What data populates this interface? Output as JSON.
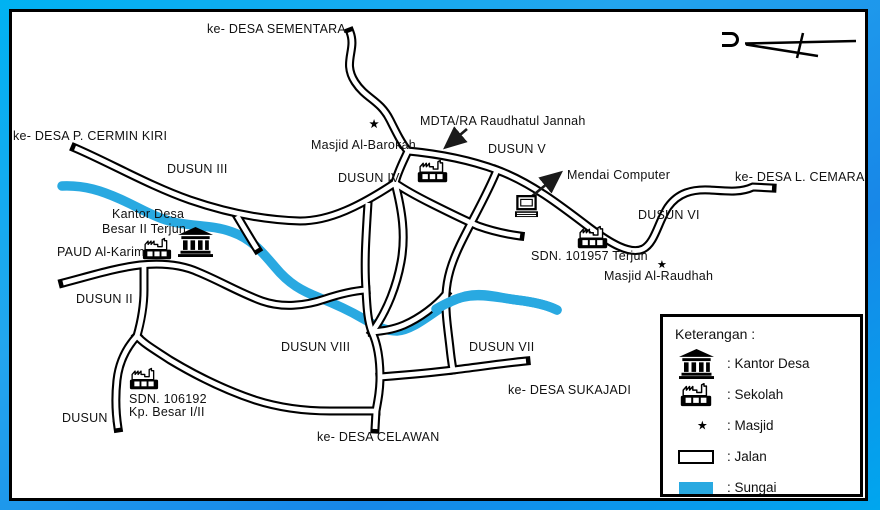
{
  "compass": {
    "north_symbol": "U"
  },
  "colors": {
    "river": "#29a9e1",
    "road_fill": "#ffffff",
    "road_outline": "#000000",
    "frame_blue_light": "#00b2f2",
    "frame_blue_dark": "#1787e8",
    "map_background": "#ffffff",
    "text": "#111111"
  },
  "map": {
    "labels": [
      {
        "id": "ke-desa-sementara",
        "text": "ke- DESA SEMENTARA",
        "x": 207,
        "y": 23
      },
      {
        "id": "ke-desa-p-cermin-kiri",
        "text": "ke- DESA P. CERMIN KIRI",
        "x": 13,
        "y": 130
      },
      {
        "id": "dusun-iii",
        "text": "DUSUN III",
        "x": 167,
        "y": 163
      },
      {
        "id": "masjid-al-barokah",
        "text": "Masjid Al-Barokah",
        "x": 311,
        "y": 139
      },
      {
        "id": "mdta-ra-raudhatul-jannah",
        "text": "MDTA/RA Raudhatul Jannah",
        "x": 420,
        "y": 115
      },
      {
        "id": "dusun-v",
        "text": "DUSUN V",
        "x": 488,
        "y": 143
      },
      {
        "id": "dusun-iv",
        "text": "DUSUN IV",
        "x": 338,
        "y": 172
      },
      {
        "id": "mendai-computer",
        "text": "Mendai Computer",
        "x": 567,
        "y": 169
      },
      {
        "id": "ke-desa-l-cemara",
        "text": "ke- DESA L. CEMARA",
        "x": 735,
        "y": 171
      },
      {
        "id": "dusun-vi",
        "text": "DUSUN VI",
        "x": 638,
        "y": 209
      },
      {
        "id": "sdn-101957-terjun",
        "text": "SDN. 101957 Terjun",
        "x": 531,
        "y": 250
      },
      {
        "id": "masjid-al-raudhah",
        "text": "Masjid Al-Raudhah",
        "x": 604,
        "y": 270
      },
      {
        "id": "kantor-desa-line1",
        "text": "Kantor Desa",
        "x": 112,
        "y": 208
      },
      {
        "id": "kantor-desa-line2",
        "text": "Besar II Terjun",
        "x": 102,
        "y": 223
      },
      {
        "id": "paud-al-karim",
        "text": "PAUD Al-Karim",
        "x": 57,
        "y": 246
      },
      {
        "id": "dusun-ii",
        "text": "DUSUN II",
        "x": 76,
        "y": 293
      },
      {
        "id": "sdn-106192-line1",
        "text": "SDN. 106192",
        "x": 129,
        "y": 393
      },
      {
        "id": "sdn-106192-line2",
        "text": "Kp. Besar I/II",
        "x": 129,
        "y": 406
      },
      {
        "id": "dusun-i",
        "text": "DUSUN I",
        "x": 62,
        "y": 412
      },
      {
        "id": "dusun-viii",
        "text": "DUSUN VIII",
        "x": 281,
        "y": 341
      },
      {
        "id": "dusun-vii",
        "text": "DUSUN VII",
        "x": 469,
        "y": 341
      },
      {
        "id": "ke-desa-sukajadi",
        "text": "ke- DESA SUKAJADI",
        "x": 508,
        "y": 384
      },
      {
        "id": "ke-desa-celawan",
        "text": "ke- DESA CELAWAN",
        "x": 317,
        "y": 431
      }
    ],
    "places": [
      {
        "id": "masjid-al-barokah-icon",
        "icon": "masjid",
        "x": 354,
        "y": 110,
        "w": 28,
        "h": 28
      },
      {
        "id": "mdta-school-icon",
        "icon": "sekolah",
        "x": 417,
        "y": 159,
        "w": 31,
        "h": 24
      },
      {
        "id": "mendai-computer-icon",
        "icon": "komputer",
        "x": 512,
        "y": 195,
        "w": 29,
        "h": 23
      },
      {
        "id": "sdn-101957-school-icon",
        "icon": "sekolah",
        "x": 577,
        "y": 225,
        "w": 31,
        "h": 24
      },
      {
        "id": "masjid-al-raudhah-icon",
        "icon": "masjid",
        "x": 644,
        "y": 252,
        "w": 25,
        "h": 25
      },
      {
        "id": "kantor-desa-icon",
        "icon": "kantor",
        "x": 177,
        "y": 227,
        "w": 37,
        "h": 30
      },
      {
        "id": "paud-school-icon",
        "icon": "sekolah",
        "x": 142,
        "y": 237,
        "w": 30,
        "h": 23
      },
      {
        "id": "sdn-106192-school-icon",
        "icon": "sekolah",
        "x": 129,
        "y": 367,
        "w": 30,
        "h": 23
      }
    ]
  },
  "legend": {
    "title": "Keterangan :",
    "items": [
      {
        "id": "kantor-desa",
        "icon": "kantor",
        "label": ": Kantor Desa"
      },
      {
        "id": "sekolah",
        "icon": "sekolah",
        "label": ": Sekolah"
      },
      {
        "id": "masjid",
        "icon": "masjid",
        "label": ": Masjid"
      },
      {
        "id": "jalan",
        "icon": "jalan",
        "label": ": Jalan"
      },
      {
        "id": "sungai",
        "icon": "sungai",
        "label": ": Sungai"
      }
    ]
  }
}
